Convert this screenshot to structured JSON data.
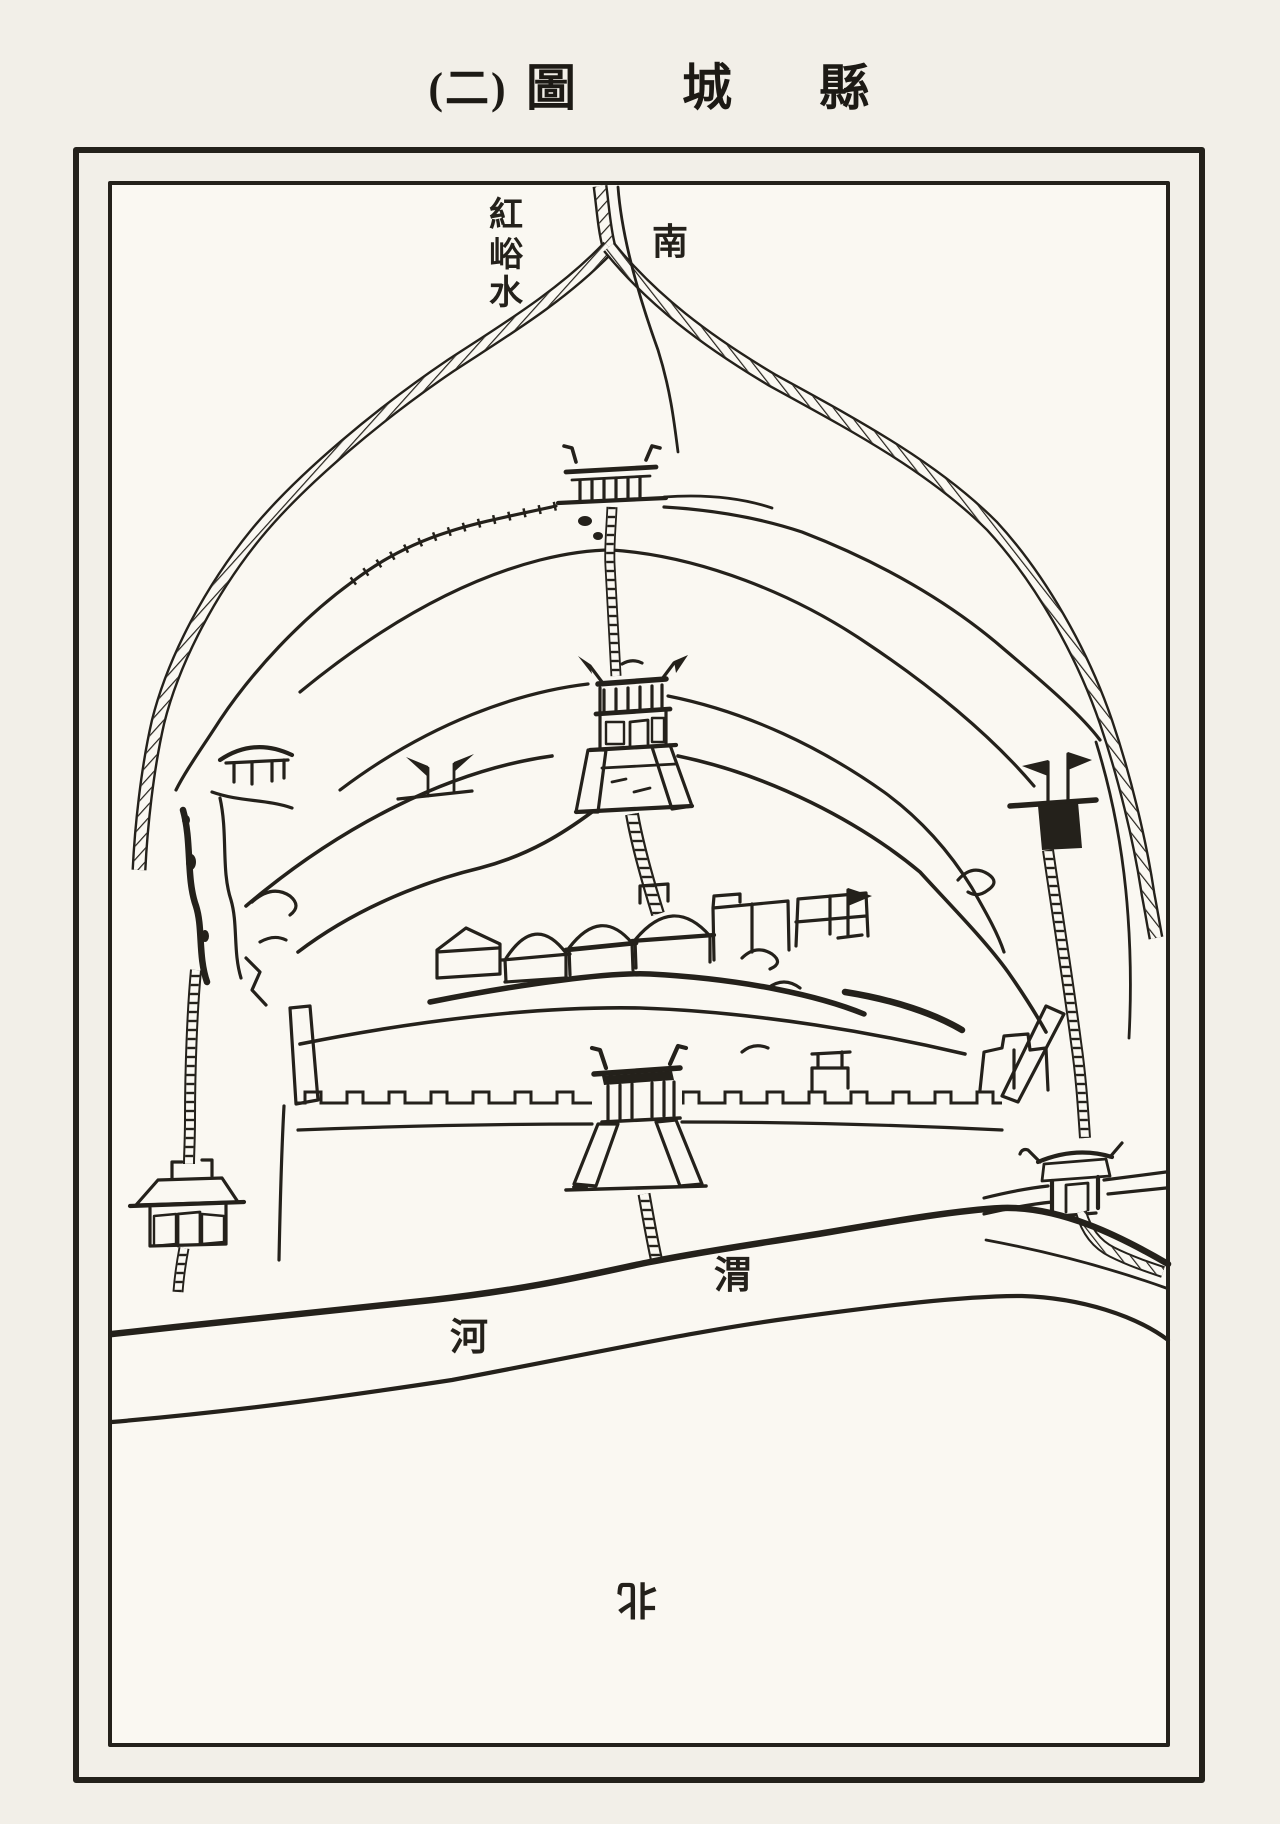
{
  "title": {
    "parts": [
      "(二)",
      "圖",
      "城",
      "縣"
    ],
    "full_display": "(二) 圖 城 縣",
    "reading_note": "縣城圖(二)"
  },
  "map_labels": {
    "stream_vertical_chars": [
      "紅",
      "峪",
      "水"
    ],
    "stream_name": "紅峪水",
    "south": "南",
    "river_char_1": "渭",
    "river_char_2": "河",
    "river_name": "渭河",
    "north": "北"
  },
  "colors": {
    "ink": "#24211b",
    "paper": "#f2efe8",
    "paper_bright": "#faf8f2"
  }
}
